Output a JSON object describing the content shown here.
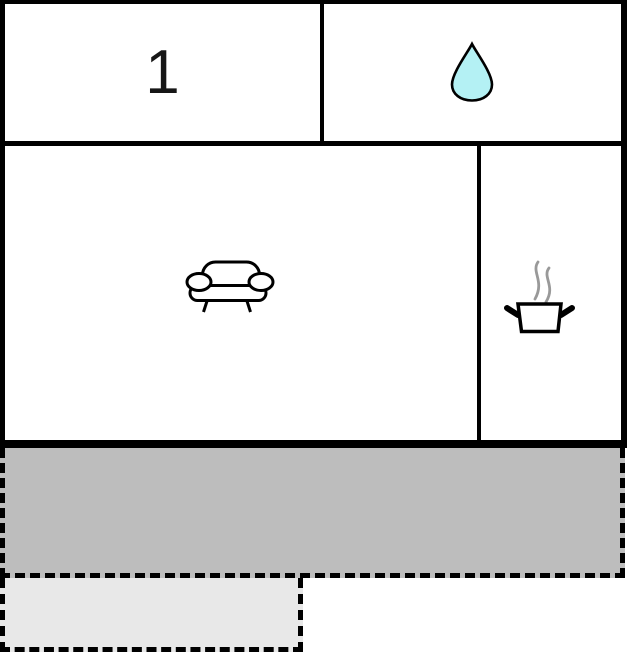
{
  "floorplan": {
    "rooms": [
      {
        "id": "bedroom",
        "label": "1",
        "icon": ""
      },
      {
        "id": "bathroom",
        "label": "",
        "icon": "water-drop"
      },
      {
        "id": "living-room",
        "label": "",
        "icon": "sofa"
      },
      {
        "id": "kitchen",
        "label": "",
        "icon": "cooking-pot"
      }
    ],
    "outdoor_areas": [
      {
        "id": "terrace",
        "outline": "dashed",
        "fill": "#bdbdbd"
      },
      {
        "id": "patio",
        "outline": "dashed",
        "fill": "#e8e8e8"
      }
    ],
    "colors": {
      "wall": "#000000",
      "icon_stroke": "#000000",
      "water_drop_fill": "#b4f1f4",
      "steam": "#999999",
      "terrace_fill": "#bdbdbd",
      "patio_fill": "#e8e8e8"
    }
  }
}
